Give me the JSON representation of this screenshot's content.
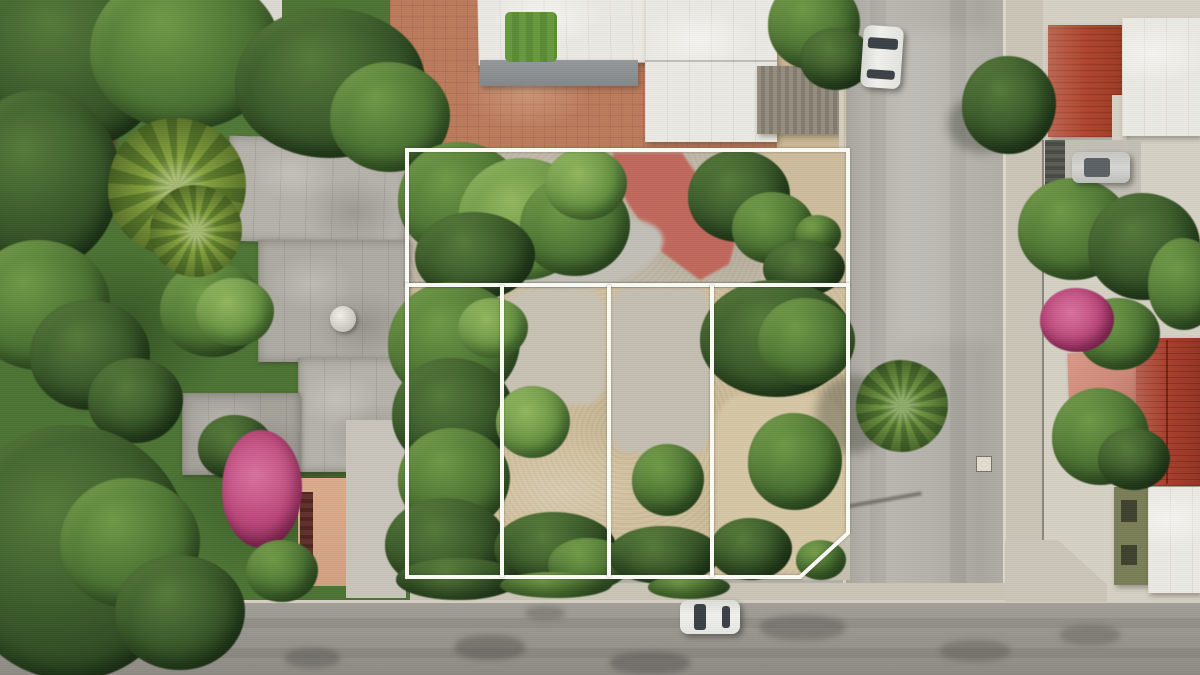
{
  "scene": {
    "description": "Aerial drone photograph of a corner property for sale: a large land parcel outlined with white boundary lines, subdivided into one wide upper parcel and four narrow lower parcels, surrounded by trees, concrete rooftops, a red painted floor slab, two streets meeting at a corner, parked cars, palm trees and pink bougainvillea",
    "type": "aerial-photo",
    "parcel_count": 5
  },
  "colors": {
    "street": "#b3b0a9",
    "asphalt": "#98958f",
    "sidewalk": "#cbc5b7",
    "sand": "#d2c2a0",
    "gravel": "#c0b8a8",
    "terracotta": "#bc7c5c",
    "red-floor": "#c26257",
    "red-roof": "#b1452d",
    "dark-red-roof": "#8e3d33",
    "pink-roof": "#cf8a79",
    "bougainvillea": "#bb4679",
    "olive-building": "#7b7f58",
    "white-roof": "#eceae3",
    "awning": "#96999c",
    "carport": "#8f8778",
    "grass": "#67993e",
    "foliage": "#4c7434",
    "palm": "#84a03c",
    "line": "#fcfcf7",
    "car-white": "#f1f1ee",
    "car-silver": "#d6d6d3"
  },
  "overlay": {
    "stroke_width": 4,
    "upper_parcel_path": "M407,150 H848 V285 H407 Z",
    "lower_parcels_path": "M407,285 H848 V533 L800,577 H407 Z",
    "divider_1_path": "M502,285 V577",
    "divider_2_path": "M609,285 V577",
    "divider_3_path": "M712,285 V577",
    "red_floor_points": "613,153 682,153 706,188 736,238 729,264 700,280 662,252 628,204 613,172"
  },
  "objects": {
    "cars": [
      {
        "name": "white car parked on right street",
        "color": "white"
      },
      {
        "name": "silver car in right-side driveway",
        "color": "silver"
      },
      {
        "name": "white car on bottom street",
        "color": "white"
      }
    ],
    "landmarks": [
      "red painted floor slab in upper parcel",
      "palm tree overhanging right street",
      "pink bougainvillea left garden",
      "pink bougainvillea right garden",
      "red tile roofs on neighboring houses",
      "white flat roofs on neighboring houses",
      "water tank dome on left rooftop",
      "green grass patch in upper courtyard"
    ]
  }
}
